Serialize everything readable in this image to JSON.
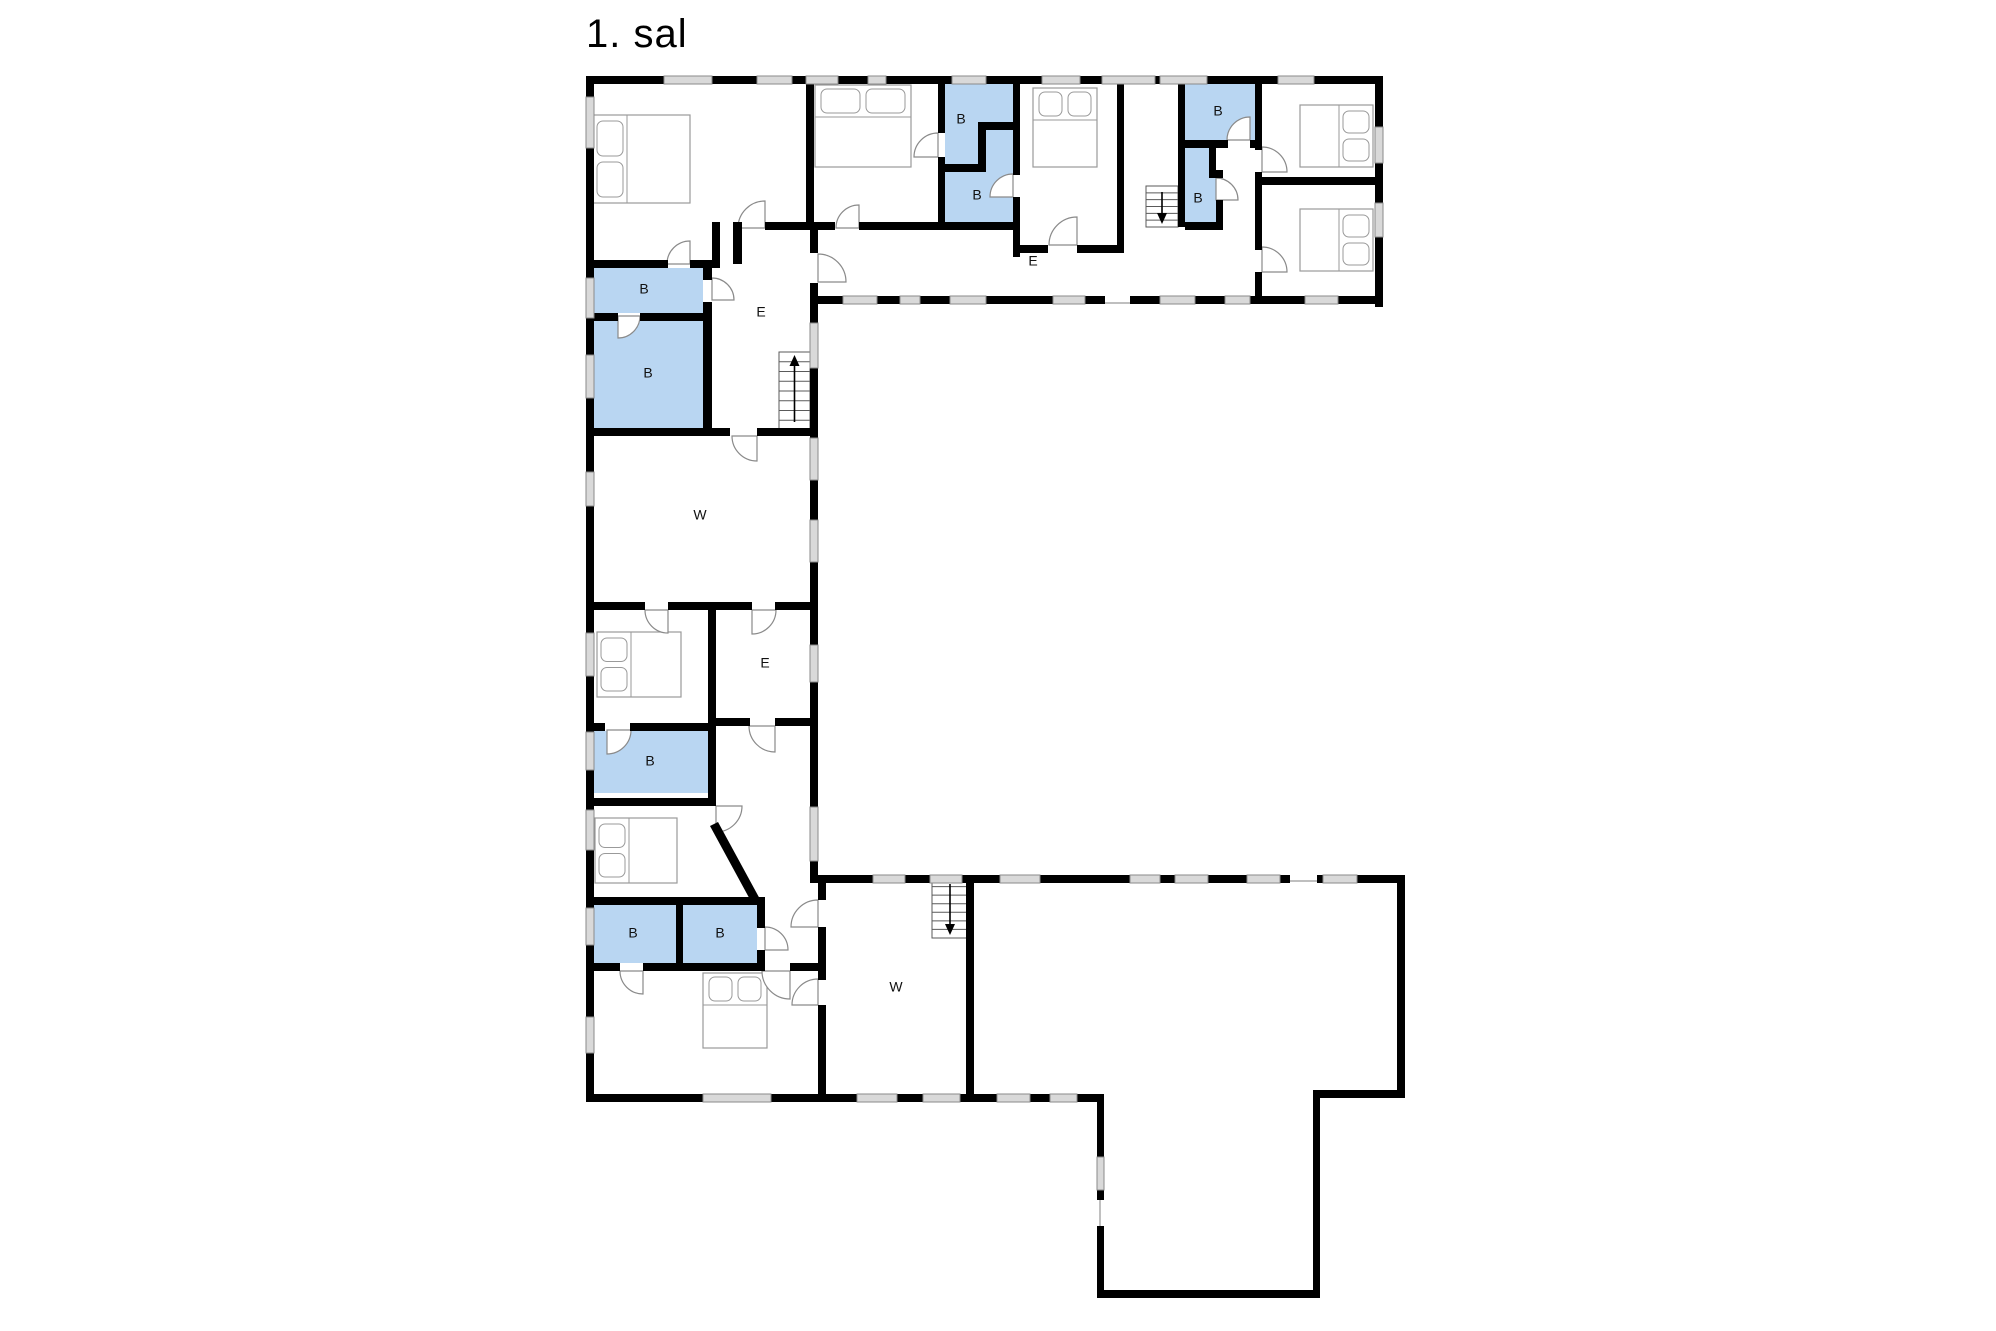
{
  "title": "1. sal",
  "canvas": {
    "width": 1996,
    "height": 1331,
    "background": "#ffffff"
  },
  "colors": {
    "wall": "#000000",
    "window_fill": "#d9d9d9",
    "window_stroke": "#8a8a8a",
    "bathroom_fill": "#b9d6f2",
    "furniture_stroke": "#9a9a9a",
    "door_stroke": "#8a8a8a",
    "stair_stroke": "#5a5a5a",
    "arrow": "#000000",
    "label": "#111111",
    "opening_line": "#aaaaaa"
  },
  "bathrooms": [
    {
      "label": "B",
      "lx": 644,
      "ly": 290,
      "shape": [
        [
          590,
          268
        ],
        [
          703,
          268
        ],
        [
          703,
          313
        ],
        [
          590,
          313
        ]
      ]
    },
    {
      "label": "B",
      "lx": 648,
      "ly": 374,
      "shape": [
        [
          590,
          321
        ],
        [
          703,
          321
        ],
        [
          703,
          428
        ],
        [
          590,
          428
        ]
      ]
    },
    {
      "label": "B",
      "lx": 650,
      "ly": 762,
      "shape": [
        [
          590,
          731
        ],
        [
          708,
          731
        ],
        [
          708,
          793
        ],
        [
          590,
          793
        ]
      ]
    },
    {
      "label": "B",
      "lx": 633,
      "ly": 934,
      "shape": [
        [
          590,
          905
        ],
        [
          676,
          905
        ],
        [
          676,
          963
        ],
        [
          590,
          963
        ]
      ]
    },
    {
      "label": "B",
      "lx": 720,
      "ly": 934,
      "shape": [
        [
          683,
          905
        ],
        [
          757,
          905
        ],
        [
          757,
          963
        ],
        [
          683,
          963
        ]
      ]
    },
    {
      "label": "B",
      "lx": 961,
      "ly": 120,
      "shape": [
        [
          945,
          84
        ],
        [
          1013,
          84
        ],
        [
          1013,
          122
        ],
        [
          986,
          122
        ],
        [
          986,
          164
        ],
        [
          945,
          164
        ]
      ]
    },
    {
      "label": "B",
      "lx": 977,
      "ly": 196,
      "shape": [
        [
          986,
          130
        ],
        [
          1013,
          130
        ],
        [
          1013,
          222
        ],
        [
          945,
          222
        ],
        [
          945,
          172
        ],
        [
          986,
          172
        ]
      ]
    },
    {
      "label": "B",
      "lx": 1218,
      "ly": 112,
      "shape": [
        [
          1185,
          84
        ],
        [
          1255,
          84
        ],
        [
          1255,
          140
        ],
        [
          1185,
          140
        ]
      ]
    },
    {
      "label": "B",
      "lx": 1198,
      "ly": 199,
      "shape": [
        [
          1185,
          148
        ],
        [
          1209,
          148
        ],
        [
          1209,
          178
        ],
        [
          1223,
          178
        ],
        [
          1223,
          222
        ],
        [
          1185,
          222
        ]
      ]
    }
  ],
  "room_labels": [
    {
      "text": "E",
      "x": 1033,
      "y": 262
    },
    {
      "text": "E",
      "x": 761,
      "y": 313
    },
    {
      "text": "W",
      "x": 700,
      "y": 516
    },
    {
      "text": "E",
      "x": 765,
      "y": 664
    },
    {
      "text": "W",
      "x": 896,
      "y": 988
    }
  ],
  "walls": [
    [
      586,
      76,
      797,
      8
    ],
    [
      586,
      76,
      8,
      1026
    ],
    [
      1375,
      76,
      8,
      231
    ],
    [
      812,
      296,
      293,
      8
    ],
    [
      1130,
      296,
      253,
      8
    ],
    [
      810,
      222,
      8,
      31
    ],
    [
      810,
      283,
      8,
      600
    ],
    [
      818,
      875,
      472,
      8
    ],
    [
      1317,
      875,
      88,
      8
    ],
    [
      1397,
      875,
      8,
      223
    ],
    [
      586,
      1094,
      518,
      8
    ],
    [
      1313,
      1090,
      92,
      8
    ],
    [
      1097,
      1094,
      7,
      63
    ],
    [
      1097,
      1190,
      7,
      10
    ],
    [
      1097,
      1226,
      7,
      72
    ],
    [
      1313,
      1090,
      7,
      208
    ],
    [
      1097,
      1290,
      223,
      8
    ],
    [
      806,
      84,
      8,
      138
    ],
    [
      733,
      222,
      9,
      42
    ],
    [
      765,
      222,
      41,
      8
    ],
    [
      586,
      260,
      82,
      8
    ],
    [
      690,
      260,
      22,
      8
    ],
    [
      712,
      222,
      8,
      46
    ],
    [
      703,
      260,
      9,
      20
    ],
    [
      703,
      302,
      9,
      132
    ],
    [
      586,
      313,
      32,
      8
    ],
    [
      640,
      313,
      63,
      8
    ],
    [
      586,
      428,
      144,
      8
    ],
    [
      757,
      428,
      57,
      8
    ],
    [
      806,
      222,
      29,
      8
    ],
    [
      859,
      222,
      86,
      8
    ],
    [
      938,
      84,
      7,
      49
    ],
    [
      938,
      157,
      7,
      73
    ],
    [
      982,
      122,
      31,
      8
    ],
    [
      978,
      122,
      8,
      50
    ],
    [
      945,
      164,
      33,
      8
    ],
    [
      945,
      222,
      75,
      8
    ],
    [
      1013,
      84,
      7,
      91
    ],
    [
      1013,
      197,
      7,
      60
    ],
    [
      1013,
      245,
      35,
      8
    ],
    [
      1077,
      245,
      47,
      8
    ],
    [
      1117,
      84,
      7,
      169
    ],
    [
      1178,
      84,
      7,
      143
    ],
    [
      1185,
      140,
      43,
      8
    ],
    [
      1250,
      140,
      12,
      8
    ],
    [
      1209,
      148,
      7,
      30
    ],
    [
      1209,
      170,
      14,
      8
    ],
    [
      1216,
      200,
      7,
      22
    ],
    [
      1185,
      222,
      38,
      8
    ],
    [
      1255,
      84,
      7,
      66
    ],
    [
      1255,
      172,
      7,
      78
    ],
    [
      1255,
      272,
      7,
      32
    ],
    [
      1255,
      177,
      128,
      8
    ],
    [
      586,
      602,
      59,
      8
    ],
    [
      668,
      602,
      84,
      8
    ],
    [
      775,
      602,
      39,
      8
    ],
    [
      708,
      610,
      8,
      113
    ],
    [
      586,
      723,
      19,
      8
    ],
    [
      630,
      723,
      78,
      8
    ],
    [
      708,
      718,
      42,
      8
    ],
    [
      775,
      718,
      39,
      8
    ],
    [
      708,
      723,
      8,
      83
    ],
    [
      586,
      798,
      128,
      8
    ],
    [
      586,
      897,
      176,
      8
    ],
    [
      676,
      897,
      7,
      74
    ],
    [
      757,
      897,
      8,
      31
    ],
    [
      757,
      950,
      8,
      21
    ],
    [
      586,
      963,
      34,
      8
    ],
    [
      643,
      963,
      122,
      8
    ],
    [
      790,
      963,
      36,
      8
    ],
    [
      818,
      875,
      8,
      25
    ],
    [
      818,
      927,
      8,
      53
    ],
    [
      818,
      1005,
      8,
      97
    ],
    [
      966,
      875,
      8,
      227
    ]
  ],
  "diagonal_walls": [
    [
      [
        710,
        826
      ],
      [
        718,
        822
      ],
      [
        761,
        901
      ],
      [
        753,
        905
      ]
    ]
  ],
  "windows": [
    [
      664,
      76,
      48,
      8
    ],
    [
      757,
      76,
      35,
      8
    ],
    [
      806,
      76,
      32,
      8
    ],
    [
      868,
      76,
      18,
      8
    ],
    [
      952,
      76,
      34,
      8
    ],
    [
      1042,
      76,
      38,
      8
    ],
    [
      1102,
      76,
      53,
      8
    ],
    [
      1160,
      76,
      47,
      8
    ],
    [
      1278,
      76,
      36,
      8
    ],
    [
      586,
      97,
      8,
      51
    ],
    [
      586,
      278,
      8,
      40
    ],
    [
      586,
      355,
      8,
      43
    ],
    [
      586,
      472,
      8,
      34
    ],
    [
      586,
      633,
      8,
      43
    ],
    [
      586,
      732,
      8,
      38
    ],
    [
      586,
      810,
      8,
      40
    ],
    [
      586,
      908,
      8,
      37
    ],
    [
      586,
      1017,
      8,
      36
    ],
    [
      1375,
      127,
      8,
      36
    ],
    [
      1375,
      203,
      8,
      34
    ],
    [
      843,
      296,
      34,
      8
    ],
    [
      900,
      296,
      20,
      8
    ],
    [
      950,
      296,
      36,
      8
    ],
    [
      1053,
      296,
      32,
      8
    ],
    [
      1160,
      296,
      35,
      8
    ],
    [
      1225,
      296,
      25,
      8
    ],
    [
      1305,
      296,
      33,
      8
    ],
    [
      810,
      323,
      8,
      45
    ],
    [
      810,
      438,
      8,
      42
    ],
    [
      810,
      520,
      8,
      42
    ],
    [
      810,
      645,
      8,
      37
    ],
    [
      810,
      807,
      8,
      54
    ],
    [
      873,
      875,
      32,
      8
    ],
    [
      930,
      875,
      32,
      8
    ],
    [
      1000,
      875,
      40,
      8
    ],
    [
      1130,
      875,
      30,
      8
    ],
    [
      1175,
      875,
      33,
      8
    ],
    [
      1247,
      875,
      33,
      8
    ],
    [
      1323,
      875,
      34,
      8
    ],
    [
      703,
      1094,
      68,
      8
    ],
    [
      857,
      1094,
      40,
      8
    ],
    [
      923,
      1094,
      37,
      8
    ],
    [
      997,
      1094,
      33,
      8
    ],
    [
      1050,
      1094,
      27,
      8
    ],
    [
      1097,
      1157,
      7,
      33
    ]
  ],
  "doors": [
    {
      "x": 765,
      "y": 228,
      "r": 27,
      "a1": 180,
      "a2": 270
    },
    {
      "x": 690,
      "y": 264,
      "r": 23,
      "a1": 180,
      "a2": 270
    },
    {
      "x": 712,
      "y": 300,
      "r": 22,
      "a1": 270,
      "a2": 360
    },
    {
      "x": 618,
      "y": 316,
      "r": 22,
      "a1": 0,
      "a2": 90
    },
    {
      "x": 757,
      "y": 436,
      "r": 25,
      "a1": 90,
      "a2": 180
    },
    {
      "x": 818,
      "y": 282,
      "r": 28,
      "a1": 270,
      "a2": 360
    },
    {
      "x": 668,
      "y": 610,
      "r": 23,
      "a1": 90,
      "a2": 180
    },
    {
      "x": 752,
      "y": 610,
      "r": 24,
      "a1": 0,
      "a2": 90
    },
    {
      "x": 775,
      "y": 726,
      "r": 26,
      "a1": 90,
      "a2": 180
    },
    {
      "x": 607,
      "y": 730,
      "r": 24,
      "a1": 0,
      "a2": 90
    },
    {
      "x": 716,
      "y": 806,
      "r": 26,
      "a1": 0,
      "a2": 90
    },
    {
      "x": 643,
      "y": 971,
      "r": 23,
      "a1": 90,
      "a2": 180
    },
    {
      "x": 765,
      "y": 950,
      "r": 23,
      "a1": 270,
      "a2": 360
    },
    {
      "x": 790,
      "y": 971,
      "r": 28,
      "a1": 90,
      "a2": 180
    },
    {
      "x": 818,
      "y": 927,
      "r": 27,
      "a1": 180,
      "a2": 270
    },
    {
      "x": 818,
      "y": 1005,
      "r": 26,
      "a1": 180,
      "a2": 270
    },
    {
      "x": 938,
      "y": 157,
      "r": 24,
      "a1": 180,
      "a2": 270
    },
    {
      "x": 1013,
      "y": 197,
      "r": 23,
      "a1": 180,
      "a2": 270
    },
    {
      "x": 1077,
      "y": 245,
      "r": 28,
      "a1": 180,
      "a2": 270
    },
    {
      "x": 1250,
      "y": 140,
      "r": 23,
      "a1": 180,
      "a2": 270
    },
    {
      "x": 1216,
      "y": 200,
      "r": 22,
      "a1": 270,
      "a2": 360
    },
    {
      "x": 1262,
      "y": 172,
      "r": 25,
      "a1": 270,
      "a2": 360
    },
    {
      "x": 1262,
      "y": 272,
      "r": 25,
      "a1": 270,
      "a2": 360
    },
    {
      "x": 859,
      "y": 228,
      "r": 23,
      "a1": 180,
      "a2": 270
    }
  ],
  "beds": [
    {
      "x": 593,
      "y": 115,
      "w": 97,
      "h": 88,
      "head": "left"
    },
    {
      "x": 815,
      "y": 85,
      "w": 96,
      "h": 82,
      "head": "top"
    },
    {
      "x": 1033,
      "y": 88,
      "w": 64,
      "h": 79,
      "head": "top"
    },
    {
      "x": 1300,
      "y": 105,
      "w": 73,
      "h": 62,
      "head": "right"
    },
    {
      "x": 1300,
      "y": 209,
      "w": 73,
      "h": 62,
      "head": "right"
    },
    {
      "x": 597,
      "y": 632,
      "w": 84,
      "h": 65,
      "head": "left"
    },
    {
      "x": 595,
      "y": 818,
      "w": 82,
      "h": 65,
      "head": "left"
    },
    {
      "x": 703,
      "y": 973,
      "w": 64,
      "h": 75,
      "head": "top"
    }
  ],
  "stairs": [
    {
      "x": 779,
      "y": 352,
      "w": 31,
      "h": 78,
      "dir": "up",
      "treads": 7
    },
    {
      "x": 1146,
      "y": 186,
      "w": 32,
      "h": 41,
      "dir": "down",
      "treads": 5
    },
    {
      "x": 932,
      "y": 878,
      "w": 36,
      "h": 60,
      "dir": "down",
      "treads": 6
    }
  ],
  "opening_lines": [
    [
      1105,
      303,
      1130,
      303
    ],
    [
      1290,
      881,
      1317,
      881
    ],
    [
      1100,
      1200,
      1100,
      1226
    ]
  ]
}
